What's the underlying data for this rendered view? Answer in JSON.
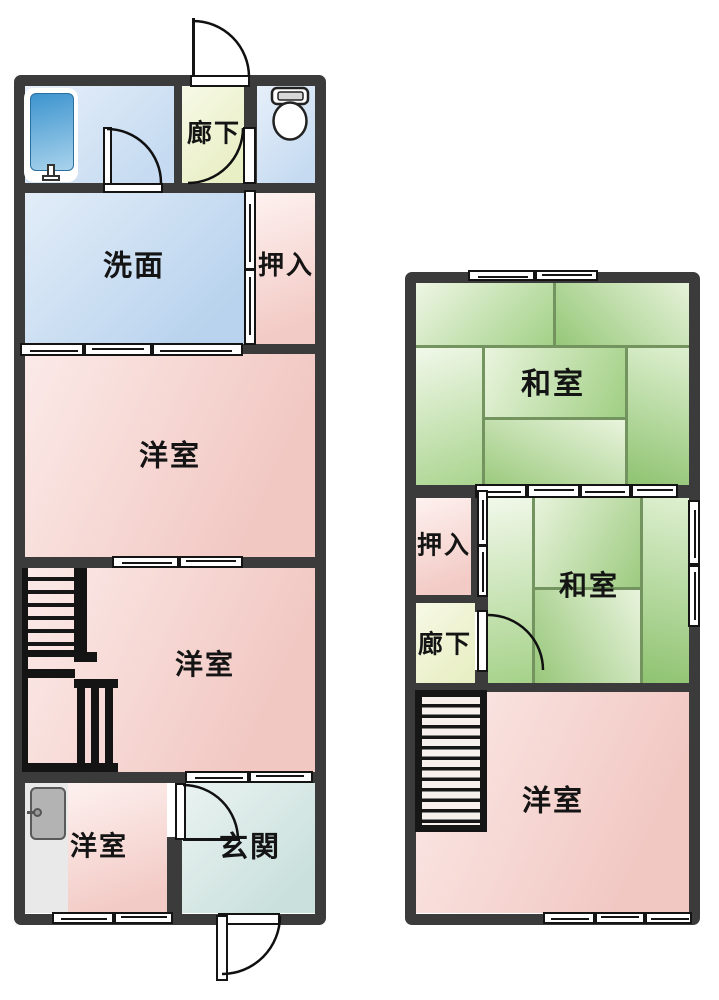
{
  "plan": {
    "type": "floor-plan",
    "colors": {
      "wall": "#3b3b3b",
      "western_room_pink": "#f2c8c3",
      "washroom_blue": "#b9d3ee",
      "entrance_teal": "#c9e0dc",
      "corridor_yellow": "#e9efc5",
      "tatami_green": "#a3d187",
      "tatami_line": "#73945f",
      "fixture_gray": "#b3b3b3"
    }
  },
  "floor1": {
    "rooms": {
      "corridor": "廊下",
      "washroom": "洗面",
      "closet": "押入",
      "western1": "洋室",
      "western2": "洋室",
      "western3": "洋室",
      "entrance": "玄関"
    },
    "fixtures": {
      "bathtub": "bathtub-icon",
      "toilet": "toilet-icon",
      "gray_door": "door-icon",
      "stairs": "staircase-up"
    }
  },
  "floor2": {
    "rooms": {
      "japanese1": "和室",
      "closet": "押入",
      "corridor": "廊下",
      "japanese2": "和室",
      "western": "洋室"
    },
    "fixtures": {
      "stairs": "staircase-down"
    }
  }
}
